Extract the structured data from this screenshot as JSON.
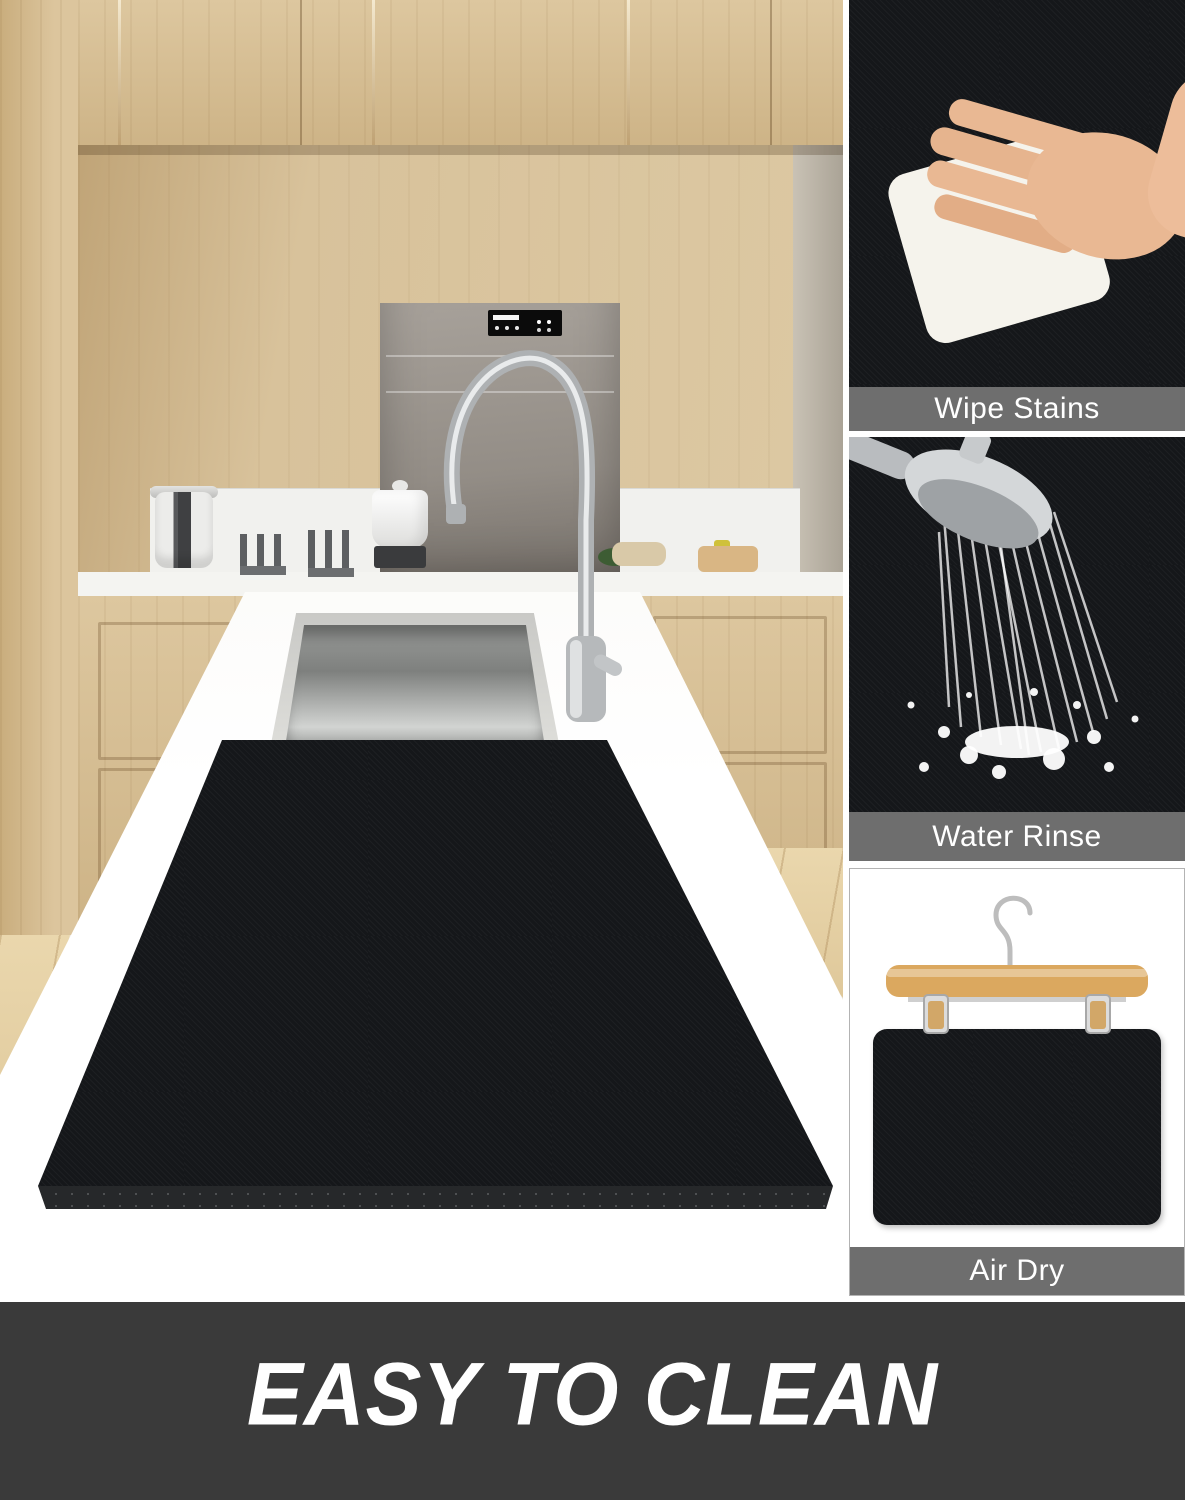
{
  "side_panels": {
    "wipe_stains": {
      "label": "Wipe Stains"
    },
    "water_rinse": {
      "label": "Water Rinse"
    },
    "air_dry": {
      "label": "Air Dry"
    }
  },
  "banner": {
    "text": "EASY TO CLEAN"
  },
  "colors": {
    "label_bar_bg": "#6e6e6e",
    "label_text": "#ffffff",
    "banner_bg": "#3a3a3a",
    "banner_text": "#ffffff",
    "mat_base": "#15171a",
    "cabinet_wood": "#d5be96",
    "hanger_wood": "#d8a65f",
    "counter_white": "#f4f3ef",
    "pattern_green": "#87a557",
    "pattern_teal": "#567584",
    "pattern_pink": "#eec4cd"
  }
}
